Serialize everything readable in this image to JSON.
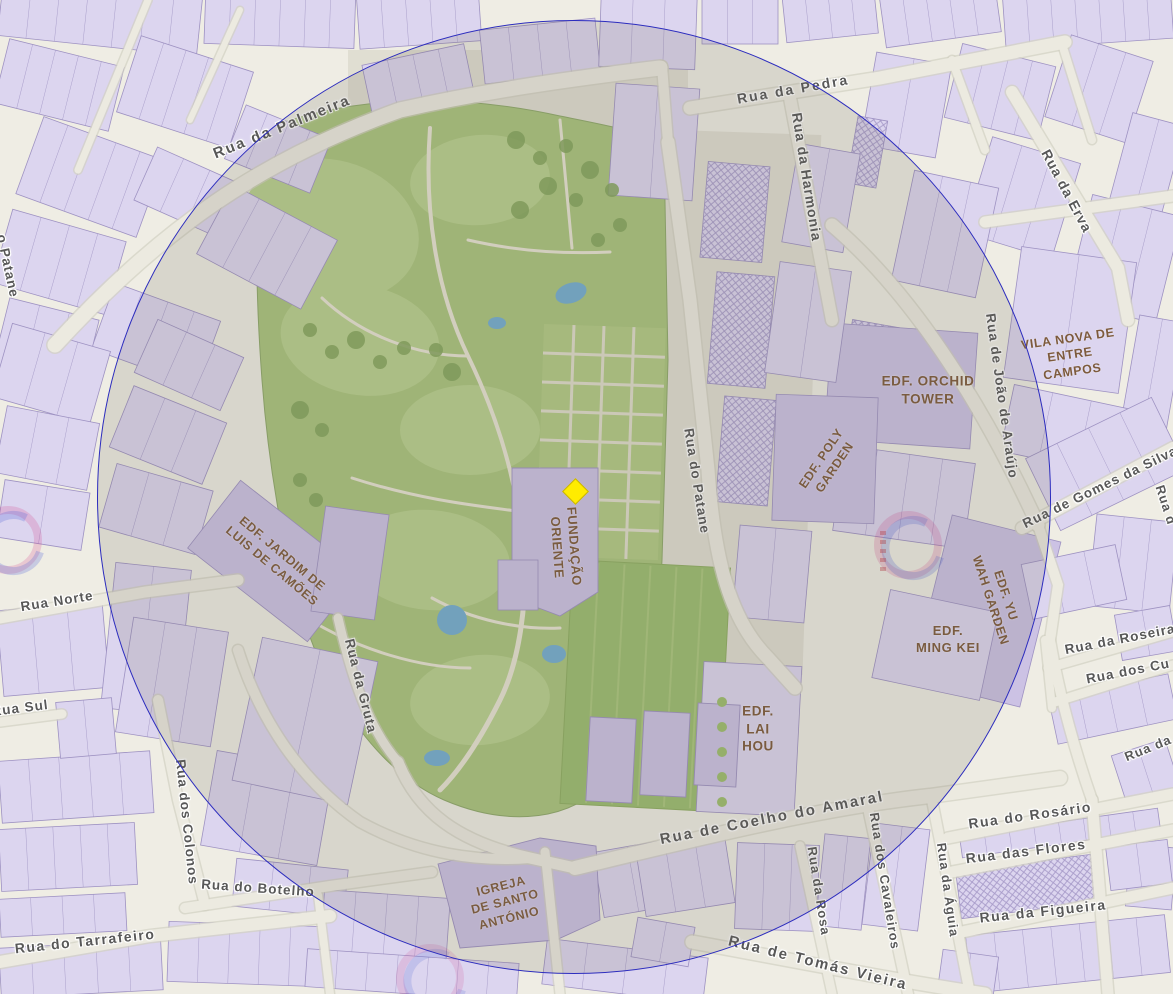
{
  "map": {
    "marker": {
      "name": "selected-location",
      "shape": "diamond",
      "color": "#FFEC00",
      "border_color": "#C9B400",
      "x": 575,
      "y": 491,
      "size": 19
    },
    "buffer_circle": {
      "cx": 574,
      "cy": 497,
      "r": 477,
      "stroke": "#2C2CBE",
      "fill": "rgba(104,99,90,0.17)"
    },
    "colors": {
      "background_street": "#EFEDE4",
      "building": "#DCD5EF",
      "building_dark": "#CCC2E4",
      "building_outline": "#9E92C2",
      "park": "#AAC47E",
      "park_light": "#B9D08E",
      "tree": "#84A55C",
      "water": "#74AED0",
      "street_label": "#585858",
      "place_label": "#7D5A3C"
    },
    "street_labels": [
      {
        "text": "Rua da Palmeira",
        "x": 282,
        "y": 127,
        "rot": -22,
        "size": 15,
        "ls": 2
      },
      {
        "text": "Rua da Pedra",
        "x": 793,
        "y": 89,
        "rot": -10,
        "size": 14,
        "ls": 2
      },
      {
        "text": "Rua da Harmonia",
        "x": 807,
        "y": 177,
        "rot": 81,
        "size": 14,
        "ls": 1
      },
      {
        "text": "Rua da Erva",
        "x": 1067,
        "y": 191,
        "rot": 62,
        "size": 14,
        "ls": 1
      },
      {
        "text": "Rua de João de Araújo",
        "x": 1002,
        "y": 396,
        "rot": 82,
        "size": 13.5,
        "ls": 1
      },
      {
        "text": "Rua de Gomes da Silva",
        "x": 1100,
        "y": 487,
        "rot": -26,
        "size": 13.5,
        "ls": 1
      },
      {
        "text": "Rua do Patane",
        "x": 697,
        "y": 481,
        "rot": 81,
        "size": 13.5,
        "ls": 1
      },
      {
        "text": "o Patane",
        "x": 8,
        "y": 266,
        "rot": 78,
        "size": 13.5,
        "ls": 1
      },
      {
        "text": "Rua Norte",
        "x": 57,
        "y": 601,
        "rot": -9,
        "size": 13.5,
        "ls": 1
      },
      {
        "text": "Rua Sul",
        "x": 20,
        "y": 708,
        "rot": -7,
        "size": 13.5,
        "ls": 1
      },
      {
        "text": "Rua da Gruta",
        "x": 361,
        "y": 686,
        "rot": 76,
        "size": 13.5,
        "ls": 1
      },
      {
        "text": "Rua dos Colonos",
        "x": 187,
        "y": 822,
        "rot": 84,
        "size": 13.5,
        "ls": 1
      },
      {
        "text": "Rua do Botelho",
        "x": 258,
        "y": 888,
        "rot": 4,
        "size": 13.5,
        "ls": 1
      },
      {
        "text": "Rua do Tarrafeiro",
        "x": 85,
        "y": 941,
        "rot": -6,
        "size": 14,
        "ls": 1.5
      },
      {
        "text": "Rua de Coelho do Amaral",
        "x": 772,
        "y": 818,
        "rot": -11,
        "size": 15,
        "ls": 2
      },
      {
        "text": "Rua da Rosa",
        "x": 819,
        "y": 891,
        "rot": 81,
        "size": 13,
        "ls": 1
      },
      {
        "text": "Rua dos Cavaleiros",
        "x": 885,
        "y": 881,
        "rot": 81,
        "size": 13,
        "ls": 1
      },
      {
        "text": "Rua da Águia",
        "x": 948,
        "y": 890,
        "rot": 82,
        "size": 13,
        "ls": 1
      },
      {
        "text": "Rua do Rosário",
        "x": 1030,
        "y": 815,
        "rot": -8,
        "size": 14,
        "ls": 1.5
      },
      {
        "text": "Rua das Flores",
        "x": 1026,
        "y": 851,
        "rot": -7,
        "size": 14,
        "ls": 1.5
      },
      {
        "text": "Rua da Figueira",
        "x": 1043,
        "y": 911,
        "rot": -6,
        "size": 14,
        "ls": 1.5
      },
      {
        "text": "Rua de Tomás Vieira",
        "x": 818,
        "y": 963,
        "rot": 14,
        "size": 15,
        "ls": 2
      },
      {
        "text": "Rua da Roseira",
        "x": 1120,
        "y": 639,
        "rot": -11,
        "size": 13.5,
        "ls": 1
      },
      {
        "text": "Rua dos Cu",
        "x": 1128,
        "y": 671,
        "rot": -11,
        "size": 13.5,
        "ls": 1
      },
      {
        "text": "Rua da",
        "x": 1148,
        "y": 748,
        "rot": -22,
        "size": 13,
        "ls": 1
      },
      {
        "text": "Rua d",
        "x": 1166,
        "y": 505,
        "rot": 72,
        "size": 13,
        "ls": 1
      }
    ],
    "place_labels": [
      {
        "text": "EDF. ORCHID\nTOWER",
        "x": 928,
        "y": 390,
        "rot": 0,
        "size": 13.5
      },
      {
        "text": "VILA NOVA DE\nENTRE CAMPOS",
        "x": 1070,
        "y": 355,
        "rot": -8,
        "size": 12.5
      },
      {
        "text": "EDF. POLY\nGARDEN",
        "x": 828,
        "y": 463,
        "rot": -56,
        "size": 12.5
      },
      {
        "text": "EDF. JARDIM DE\nLUIS DE CAMÕES",
        "x": 277,
        "y": 560,
        "rot": 40,
        "size": 12.5
      },
      {
        "text": "FUNDAÇÃO\nORIENTE",
        "x": 565,
        "y": 547,
        "rot": 86,
        "size": 13
      },
      {
        "text": "EDF. YU\nWAH GARDEN",
        "x": 998,
        "y": 598,
        "rot": 72,
        "size": 12.5
      },
      {
        "text": "EDF.\nMING KEI",
        "x": 948,
        "y": 640,
        "rot": 0,
        "size": 13
      },
      {
        "text": "EDF.\nLAI\nHOU",
        "x": 758,
        "y": 729,
        "rot": 0,
        "size": 13.5
      },
      {
        "text": "IGREJA\nDE SANTO\nANTÓNIO",
        "x": 505,
        "y": 902,
        "rot": -14,
        "size": 12.5
      }
    ]
  }
}
